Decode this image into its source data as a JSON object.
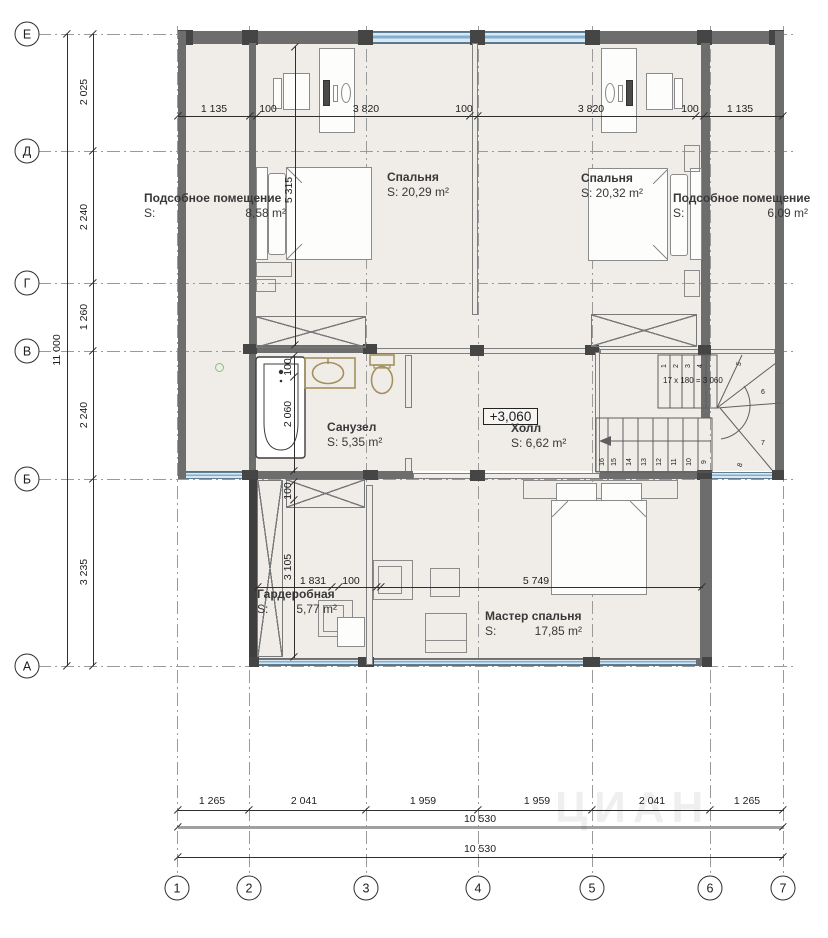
{
  "axes": {
    "rows": [
      "Е",
      "Д",
      "Г",
      "В",
      "Б",
      "А"
    ],
    "cols": [
      "1",
      "2",
      "3",
      "4",
      "5",
      "6",
      "7"
    ]
  },
  "rooms": {
    "utility_left": {
      "name": "Подсобное помещение",
      "s": "S:",
      "area": "8,58 m²"
    },
    "bedroom_left": {
      "name": "Спальня",
      "area": "S: 20,29 m²"
    },
    "bedroom_right": {
      "name": "Спальня",
      "area": "S: 20,32 m²"
    },
    "utility_right": {
      "name": "Подсобное помещение",
      "s": "S:",
      "area": "6,09 m²"
    },
    "bathroom": {
      "name": "Санузел",
      "area": "S: 5,35 m²"
    },
    "hall": {
      "name": "Холл",
      "area": "S: 6,62 m²",
      "level": "+3,060"
    },
    "wardrobe": {
      "name": "Гардеробная",
      "s": "S:",
      "area": "5,77 m²"
    },
    "master": {
      "name": "Мастер спальня",
      "s": "S:",
      "area": "17,85 m²"
    }
  },
  "dims": {
    "left": [
      "2 025",
      "2 240",
      "1 260",
      "2 240",
      "3 235"
    ],
    "left_total": "11 000",
    "top": [
      "1 135",
      "100",
      "3 820",
      "100",
      "3 820",
      "100",
      "1 135"
    ],
    "bottom": [
      "1 265",
      "2 041",
      "1 959",
      "1 959",
      "2 041",
      "1 265"
    ],
    "bottom_total_1": "10 530",
    "bottom_total_2": "10 530",
    "bedroom_depth": "5 315",
    "bath_wall": "100",
    "bath_width": "2 060",
    "wardrobe_wall": "100",
    "wardrobe_depth": "3 105",
    "wardrobe_width": "1 831",
    "wardrobe_wall2": "100",
    "master_width": "5 749"
  },
  "stairs": {
    "formula": "17 x 180 = 3 060",
    "upper": [
      "1",
      "2",
      "3",
      "4"
    ],
    "winders": [
      "5",
      "6",
      "7",
      "8"
    ],
    "lower": [
      "9",
      "10",
      "11",
      "12",
      "13",
      "14",
      "15",
      "16"
    ]
  },
  "watermark": "ЦИАН"
}
